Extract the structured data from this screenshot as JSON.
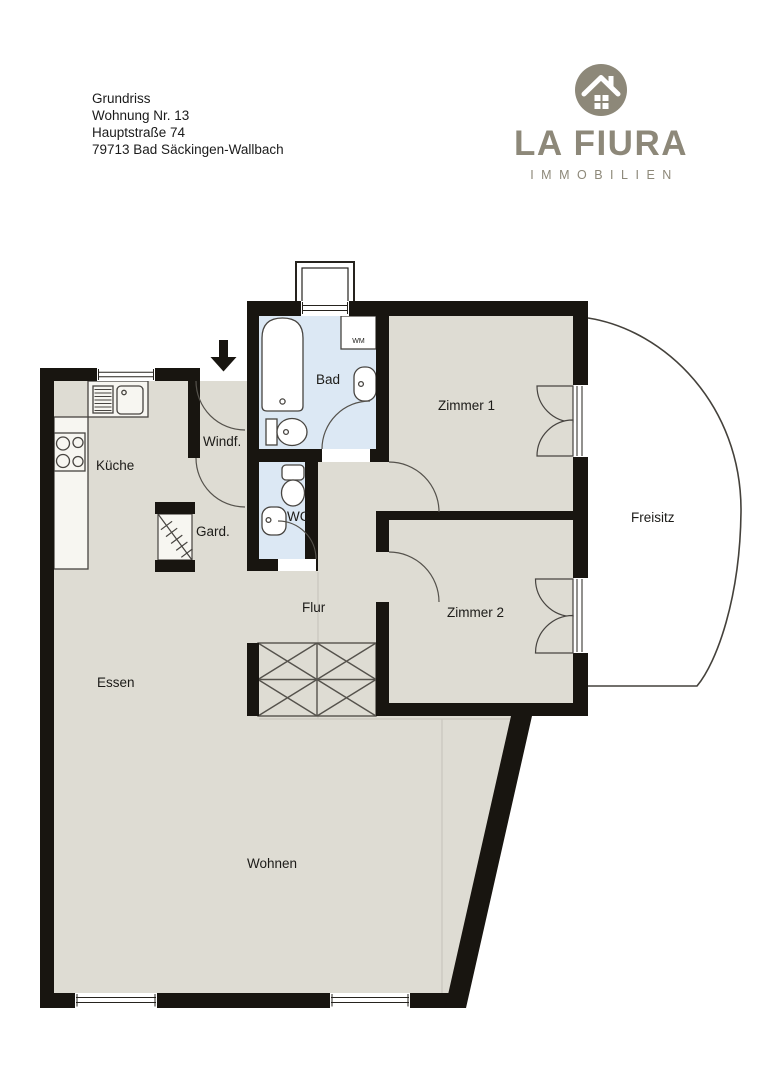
{
  "header": {
    "line1": "Grundriss",
    "line2": "Wohnung Nr. 13",
    "line3": "Hauptstraße 74",
    "line4": "79713 Bad Säckingen-Wallbach"
  },
  "logo": {
    "brand": "LA FIURA",
    "tagline": "IMMOBILIEN",
    "color": "#8d8879"
  },
  "floorplan": {
    "colors": {
      "wall": "#181510",
      "floor": "#dedcd3",
      "wet_room": "#dce8f4",
      "fixture_line": "#474440",
      "outline": "#44413b"
    },
    "rooms": {
      "kueche": "Küche",
      "windfang": "Windf.",
      "garderobe": "Gard.",
      "bad": "Bad",
      "wc": "WC",
      "zimmer1": "Zimmer 1",
      "zimmer2": "Zimmer 2",
      "flur": "Flur",
      "essen": "Essen",
      "wohnen": "Wohnen",
      "freisitz": "Freisitz",
      "waschmaschine": "WM"
    }
  }
}
